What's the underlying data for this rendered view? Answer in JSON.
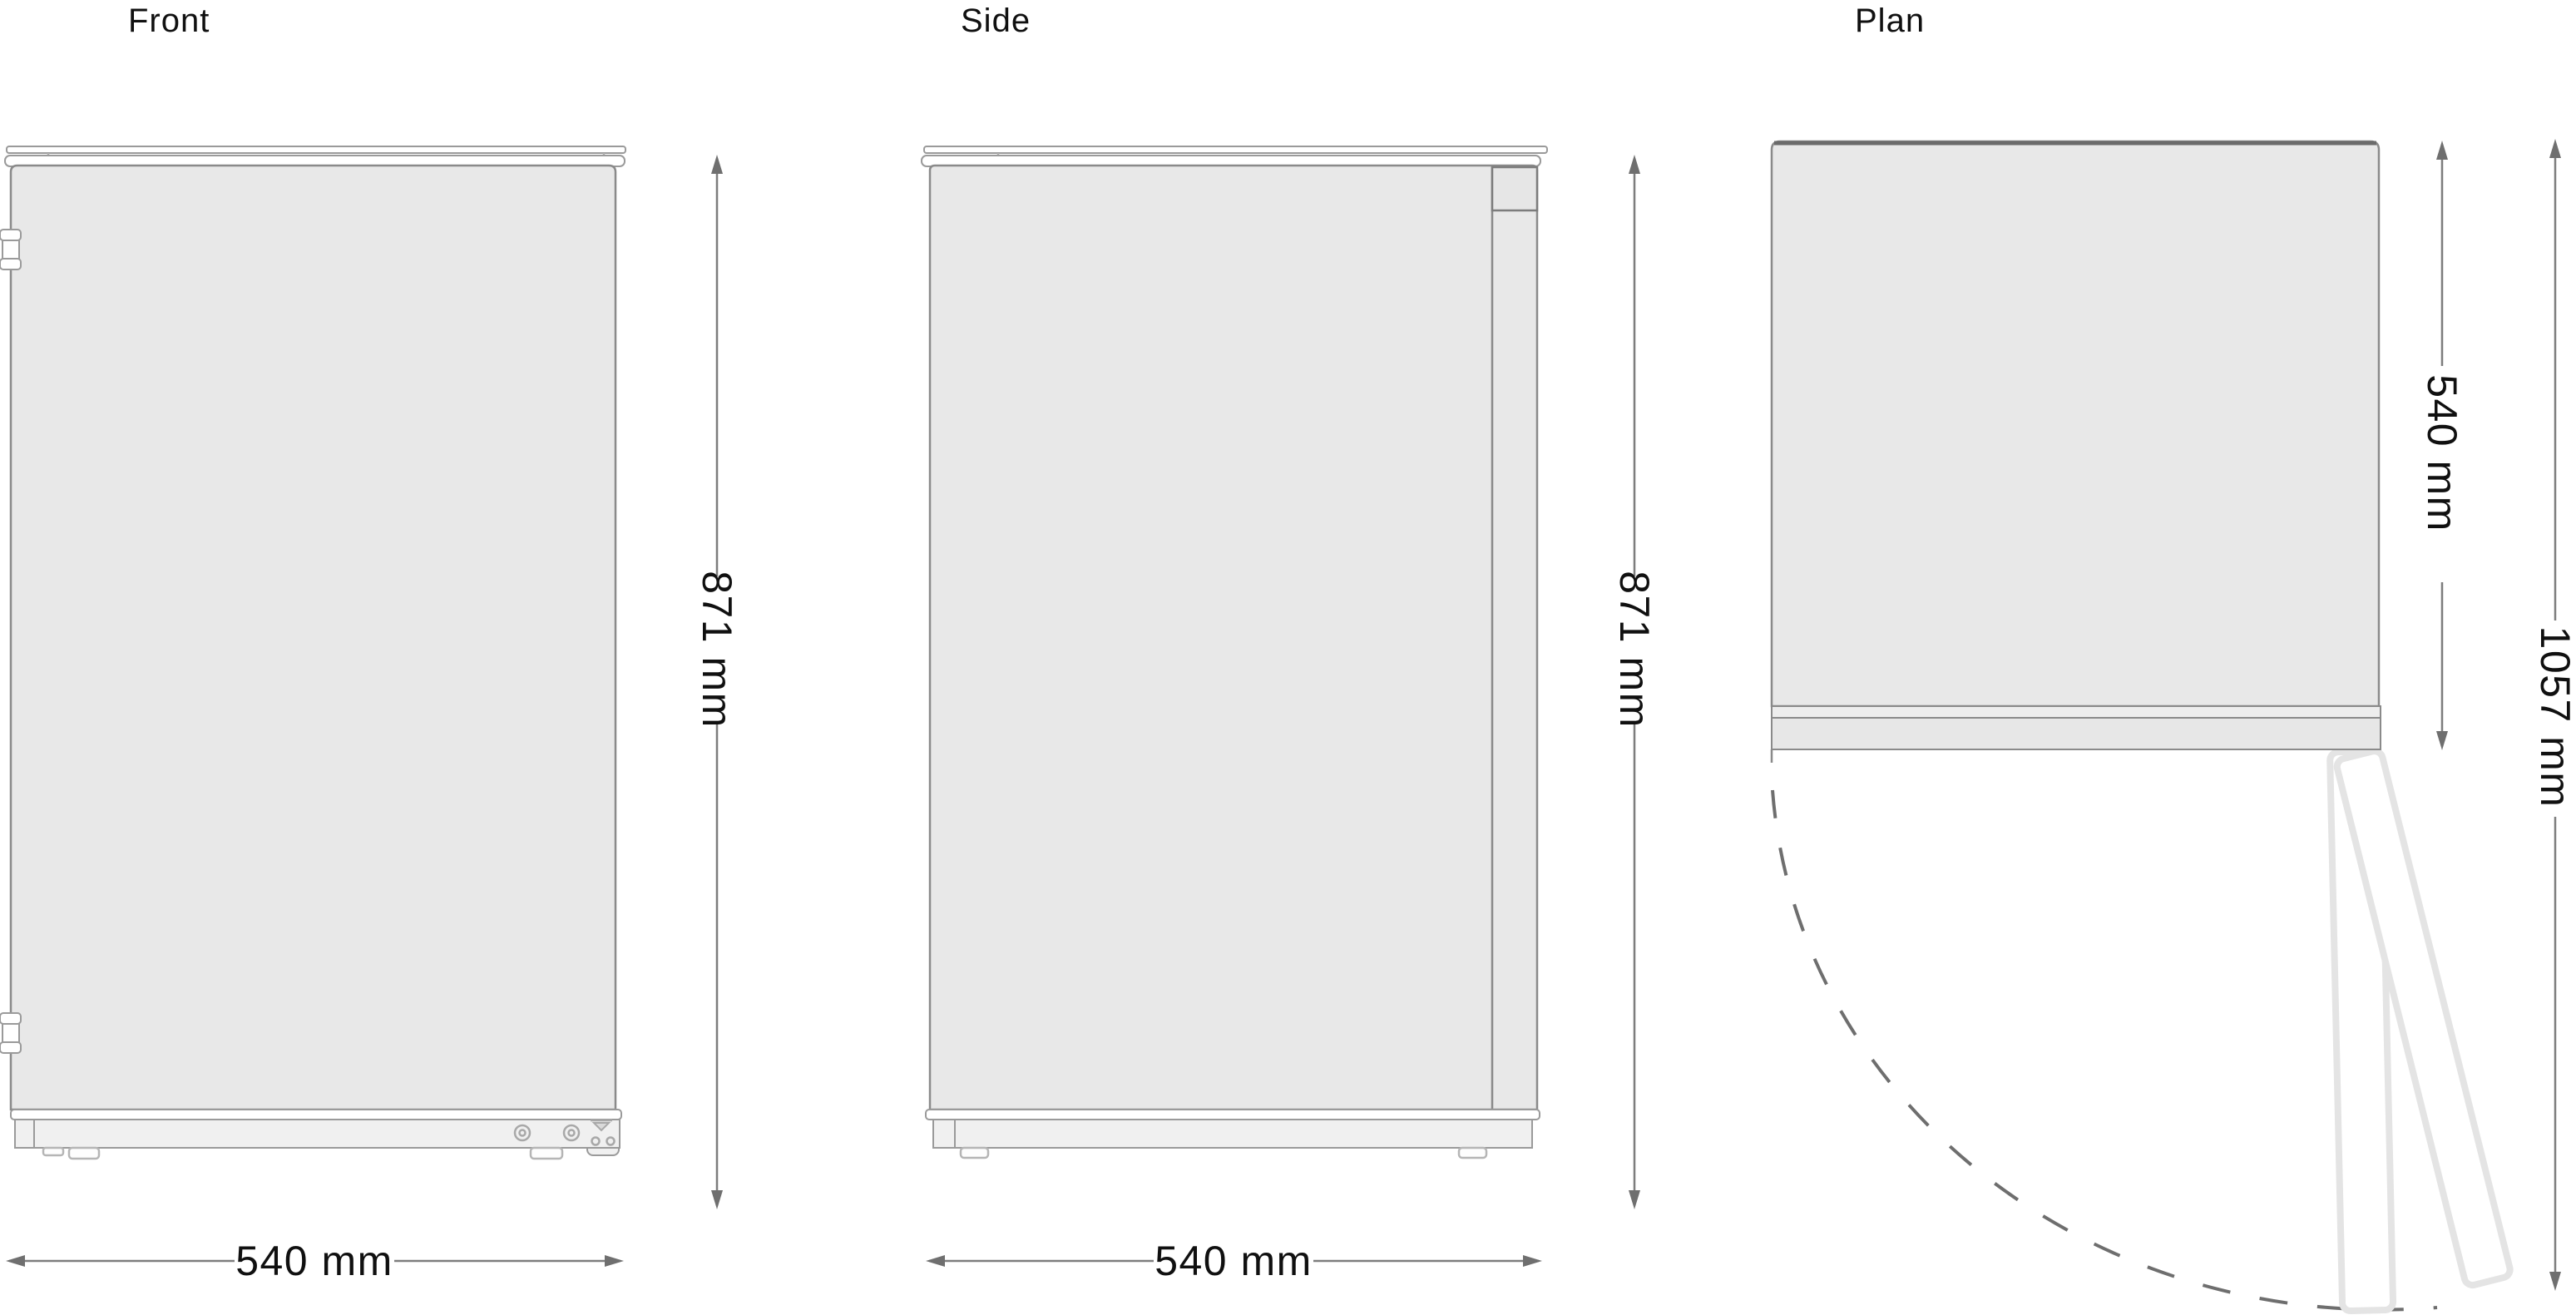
{
  "titles": {
    "front": "Front",
    "side": "Side",
    "plan": "Plan"
  },
  "dimensions": {
    "front_height": "871 mm",
    "front_width": "540 mm",
    "side_height": "871 mm",
    "side_depth": "540 mm",
    "plan_depth": "540 mm",
    "plan_door_swing": "1057 mm"
  },
  "colors": {
    "background": "#ffffff",
    "panel_fill": "#e8e8e8",
    "outline": "#8a8a8a",
    "trim_fill": "#ffffff",
    "base_fill": "#f0f0f0",
    "plan_back_edge": "#6b6b6b",
    "open_door_outline": "#e4e4e4",
    "swing_arc": "#6e6e6e",
    "dimension_line": "#7d7d7d",
    "arrowhead": "#6f6f6f",
    "text": "#101010"
  }
}
